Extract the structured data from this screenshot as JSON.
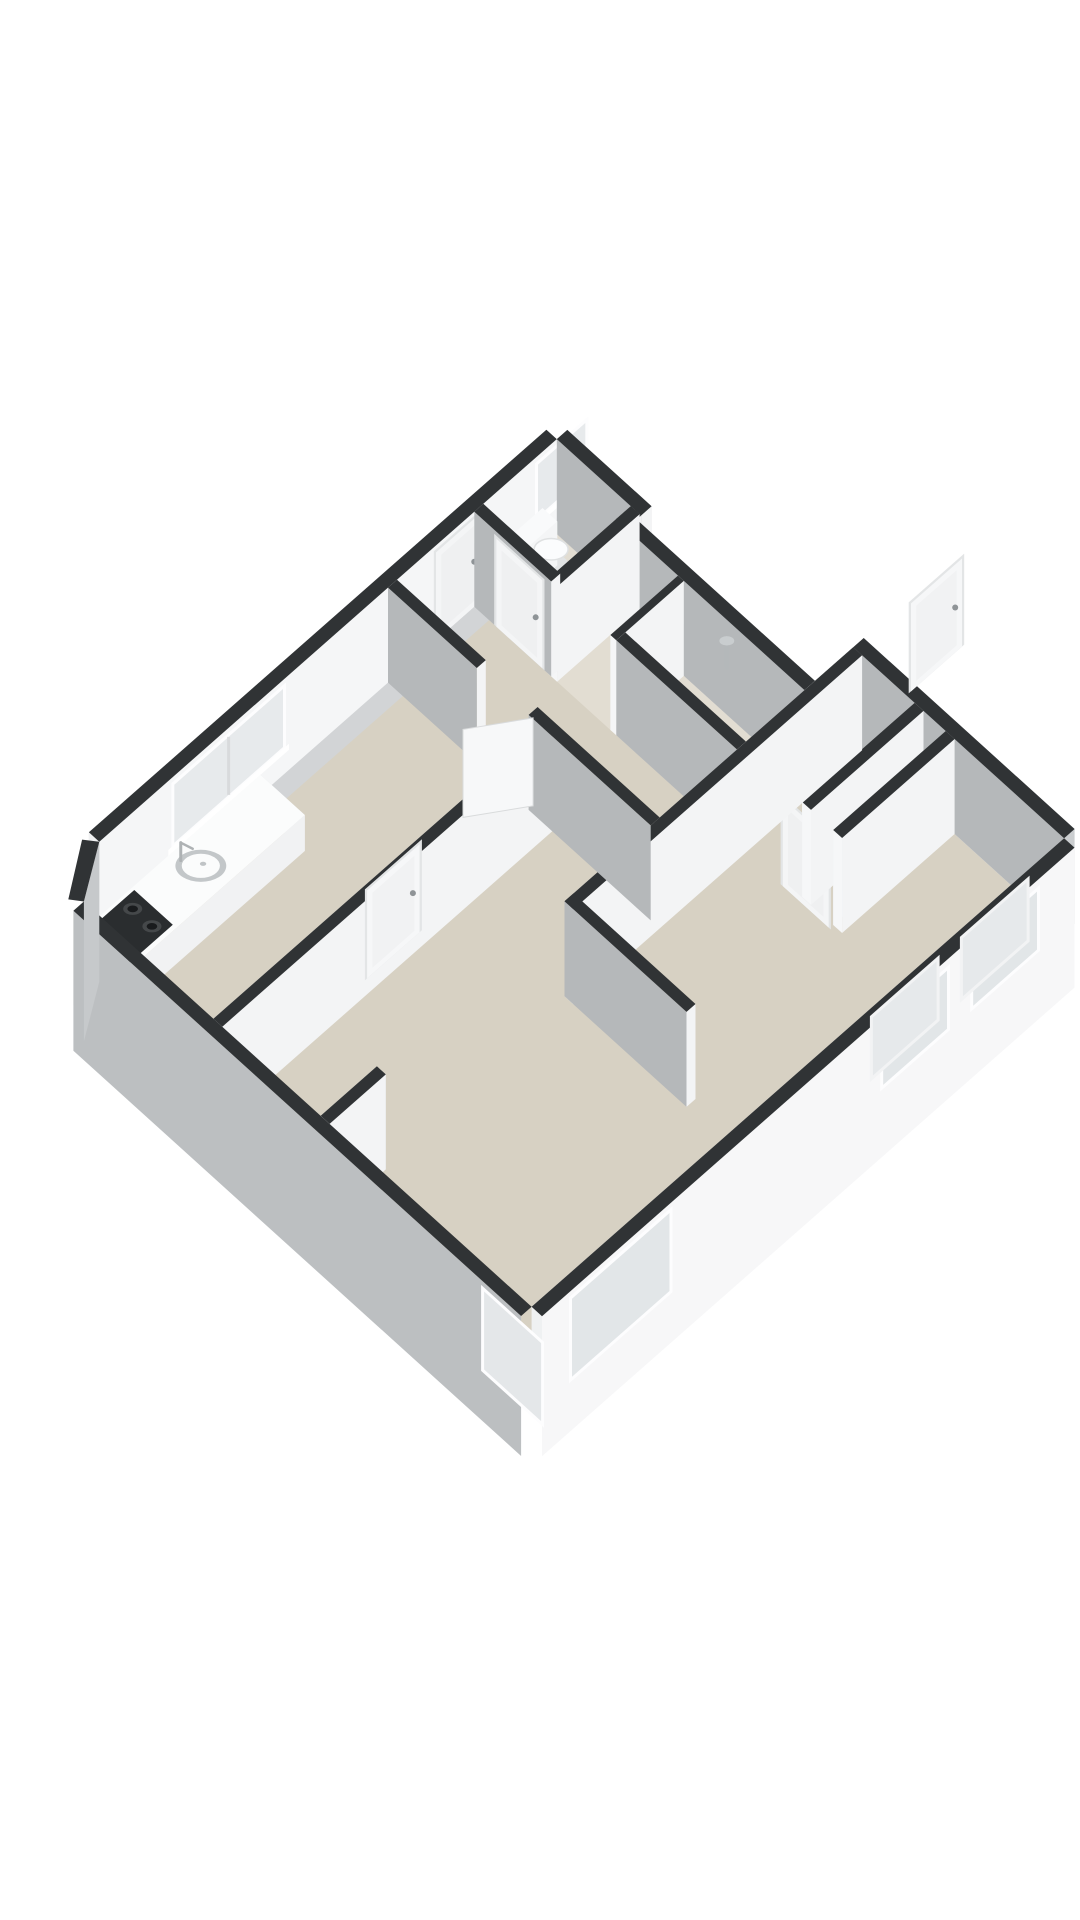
{
  "meta": {
    "label": "3D isometric floor plan of an apartment",
    "background": "#ffffff"
  },
  "palette": {
    "wall_top": "#303335",
    "wall_bright": "#f5f6f7",
    "wall_light": "#eef0f1",
    "wall_shadow": "#b5b8ba",
    "wall_outer_ne": "#cbced0",
    "wall_outer_nw": "#d2d4d6",
    "wall_outer_sw": "#bcbfc1",
    "wall_outer_se": "#f7f7f8",
    "floor_main": "#d7d1c3",
    "floor_wet": "#e2ddd2",
    "glass": "#e7eaec",
    "fixture_white": "#fbfcfd",
    "stove_black": "#2a2d2f",
    "chrome": "#aeb2b4"
  },
  "projection": {
    "origin": [
      58,
      973
    ],
    "au": [
      0.74,
      0.67
    ],
    "av": [
      0.75,
      -0.66
    ],
    "wall_height": 95,
    "skirt_depth": 45
  },
  "scene": [
    {
      "name": "floor-living-kitchen",
      "type": "floor",
      "z": 0,
      "color": "#d7d1c3",
      "points": [
        [
          35,
          0
        ],
        [
          640,
          0
        ],
        [
          640,
          710
        ],
        [
          355,
          710
        ],
        [
          355,
          645
        ],
        [
          114,
          645
        ],
        [
          114,
          665
        ],
        [
          0,
          665
        ],
        [
          0,
          55
        ]
      ]
    },
    {
      "name": "floor-wet-rooms",
      "type": "floor",
      "z": 0,
      "color": "#e2ddd2",
      "points": [
        [
          0,
          555
        ],
        [
          355,
          555
        ],
        [
          355,
          645
        ],
        [
          114,
          645
        ],
        [
          114,
          665
        ],
        [
          0,
          665
        ]
      ]
    },
    {
      "name": "wall-nw-facade",
      "type": "box",
      "x": [
        -14,
        0
      ],
      "y": [
        55,
        665
      ],
      "faces": {
        "top": "#303335",
        "E": "#f5f6f7",
        "W": "#d2d4d6",
        "S": "#f0f1f2"
      },
      "skirt": [
        "W"
      ],
      "decals": [
        {
          "kind": "window",
          "side": "E",
          "u": [
            100,
            245
          ],
          "z": [
            28,
            86
          ],
          "frame": "#fdfdfe",
          "glass": "#e7eaec",
          "mullion": true,
          "sill": true,
          "name": "kitchen-window"
        },
        {
          "kind": "window",
          "side": "E",
          "u": [
            585,
            648
          ],
          "z": [
            34,
            86
          ],
          "frame": "#fdfdfe",
          "glass": "#e7eaec",
          "sill": true,
          "name": "toilet-window"
        },
        {
          "kind": "door",
          "side": "E",
          "u": [
            449,
            509
          ],
          "z": [
            0,
            88
          ],
          "slab": "#f4f5f6",
          "handle": "end",
          "name": "entry-door"
        }
      ]
    },
    {
      "name": "wall-toilet-ne",
      "type": "box",
      "x": [
        0,
        114
      ],
      "y": [
        665,
        679
      ],
      "faces": {
        "top": "#303335",
        "S": "#b5b8ba",
        "N": "#cbced0",
        "E": "#f3f4f5"
      }
    },
    {
      "name": "wall-toilet-step",
      "type": "box",
      "x": [
        100,
        114
      ],
      "y": [
        645,
        665
      ],
      "faces": {
        "top": "#303335",
        "E": "#f3f4f5",
        "W": "#eef0f1"
      }
    },
    {
      "name": "wall-bath-ne",
      "type": "box",
      "x": [
        100,
        355
      ],
      "y": [
        645,
        659
      ],
      "faces": {
        "top": "#303335",
        "S": "#b5b8ba",
        "N": "#cbced0"
      }
    },
    {
      "name": "shower-pipe",
      "type": "rod",
      "from": [
        252,
        643,
        50
      ],
      "to": [
        252,
        643,
        74
      ],
      "w": 4,
      "color": "#b4b8ba"
    },
    {
      "name": "shower-arm",
      "type": "rod",
      "from": [
        252,
        643,
        74
      ],
      "to": [
        245,
        650,
        68
      ],
      "w": 3,
      "color": "#b4b8ba"
    },
    {
      "name": "shower-head",
      "type": "disc",
      "c": [
        244,
        651,
        66
      ],
      "r": 7,
      "color": "#c9cdcf"
    },
    {
      "name": "toilet-bowl-base",
      "type": "disc",
      "c": [
        40,
        620,
        26
      ],
      "r": 15,
      "color": "#e2e4e5"
    },
    {
      "name": "toilet-tank",
      "type": "box",
      "x": [
        4,
        24
      ],
      "y": [
        598,
        642
      ],
      "z": [
        0,
        44
      ],
      "faces": {
        "top": "#f9fafb",
        "S": "#ebedee",
        "E": "#f4f5f6"
      }
    },
    {
      "name": "toilet-bowl",
      "type": "disc",
      "c": [
        38,
        620,
        40
      ],
      "r": 16,
      "color": "#fbfcfd",
      "stroke": "#dfe1e2"
    },
    {
      "name": "wall-toilet-east",
      "type": "box",
      "x": [
        100,
        112
      ],
      "y": [
        555,
        665
      ],
      "faces": {
        "top": "#303335",
        "W": "#eef0f1",
        "E": "#f3f4f5",
        "S": "#f5f6f7"
      }
    },
    {
      "name": "wall-closet-east",
      "type": "box",
      "x": [
        184,
        192
      ],
      "y": [
        555,
        645
      ],
      "faces": {
        "top": "#303335",
        "W": "#eef0f1",
        "E": "#f3f4f5",
        "S": "#f5f6f7"
      }
    },
    {
      "name": "wall-ne-return",
      "type": "box",
      "x": [
        355,
        369
      ],
      "y": [
        645,
        710
      ],
      "faces": {
        "top": "#303335",
        "W": "#eef0f1",
        "S": "#f0f1f2"
      }
    },
    {
      "name": "wall-bedroom-ne",
      "type": "box",
      "x": [
        355,
        640
      ],
      "y": [
        710,
        724
      ],
      "faces": {
        "top": "#303335",
        "S": "#b5b8ba",
        "N": "#cbced0"
      },
      "decals": [
        {
          "kind": "slot",
          "side": "S",
          "u": [
            365,
            425
          ],
          "z": [
            55,
            83
          ],
          "frame": "#f4f5f6",
          "glass": "#3b3e40",
          "name": "bedroom-top-window"
        }
      ]
    },
    {
      "name": "wall-toilet-south",
      "type": "box",
      "x": [
        0,
        104
      ],
      "y": [
        555,
        567
      ],
      "faces": {
        "top": "#303335",
        "S": "#b5b8ba",
        "E": "#f3f4f5"
      },
      "decals": [
        {
          "kind": "door",
          "side": "S",
          "u": [
            30,
            92
          ],
          "z": [
            0,
            88
          ],
          "slab": "#f4f5f6",
          "handle": "end",
          "name": "toilet-door"
        }
      ]
    },
    {
      "name": "wall-bath-south",
      "type": "box",
      "x": [
        192,
        355
      ],
      "y": [
        555,
        567
      ],
      "faces": {
        "top": "#303335",
        "S": "#b5b8ba",
        "W": "#eef0f1",
        "E": "#f3f4f5"
      },
      "decals": [
        {
          "kind": "door",
          "side": "S",
          "u": [
            225,
            287
          ],
          "z": [
            0,
            88
          ],
          "slab": "#f4f5f6",
          "handle": "end",
          "name": "bathroom-door"
        }
      ]
    },
    {
      "name": "closet-partition-1",
      "type": "box",
      "x": [
        438,
        450
      ],
      "y": [
        560,
        710
      ],
      "faces": {
        "top": "#303335",
        "W": "#eef0f1",
        "E": "#f3f4f5",
        "S": "#f6f7f8"
      }
    },
    {
      "name": "closet-partition-2",
      "type": "box",
      "x": [
        480,
        492
      ],
      "y": [
        560,
        710
      ],
      "faces": {
        "top": "#303335",
        "W": "#eef0f1",
        "E": "#f3f4f5",
        "S": "#f6f7f8"
      }
    },
    {
      "name": "wall-bedroom-west",
      "type": "box",
      "x": [
        355,
        367
      ],
      "y": [
        325,
        710
      ],
      "faces": {
        "top": "#303335",
        "W": "#eef0f1",
        "E": "#f3f4f5",
        "S": "#f2f3f4"
      },
      "decals": [
        {
          "kind": "door",
          "side": "W",
          "u": [
            462,
            530
          ],
          "z": [
            0,
            88
          ],
          "slab": "#f6f7f8",
          "handle": "end",
          "name": "bedroom-door"
        }
      ]
    },
    {
      "name": "wall-bedroom-south",
      "type": "box",
      "x": [
        355,
        520
      ],
      "y": [
        325,
        337
      ],
      "faces": {
        "top": "#303335",
        "S": "#b5b8ba",
        "E": "#f3f4f5"
      }
    },
    {
      "name": "kitchen-counter",
      "type": "box",
      "x": [
        12,
        72
      ],
      "y": [
        12,
        258
      ],
      "z": [
        0,
        36
      ],
      "faces": {
        "top": "#fbfcfc",
        "S": "#e8eaeb",
        "E": "#f1f2f3",
        "N": "#e2e4e5"
      }
    },
    {
      "name": "stove-plate",
      "type": "plate",
      "z": 37,
      "color": "#2a2d2f",
      "points": [
        [
          16,
          18
        ],
        [
          68,
          18
        ],
        [
          68,
          86
        ],
        [
          16,
          86
        ]
      ]
    },
    {
      "name": "burner-ring-1",
      "type": "disc",
      "c": [
        30,
        33,
        38
      ],
      "r": 9,
      "color": "#45484a"
    },
    {
      "name": "burner-1",
      "type": "disc",
      "c": [
        30,
        33,
        38
      ],
      "r": 5,
      "color": "#191b1d"
    },
    {
      "name": "burner-ring-2",
      "type": "disc",
      "c": [
        56,
        33,
        38
      ],
      "r": 9,
      "color": "#45484a"
    },
    {
      "name": "burner-2",
      "type": "disc",
      "c": [
        56,
        33,
        38
      ],
      "r": 5,
      "color": "#191b1d"
    },
    {
      "name": "burner-ring-3",
      "type": "disc",
      "c": [
        30,
        70,
        38
      ],
      "r": 9,
      "color": "#45484a"
    },
    {
      "name": "burner-3",
      "type": "disc",
      "c": [
        30,
        70,
        38
      ],
      "r": 5,
      "color": "#191b1d"
    },
    {
      "name": "burner-ring-4",
      "type": "disc",
      "c": [
        56,
        70,
        38
      ],
      "r": 9,
      "color": "#45484a"
    },
    {
      "name": "burner-4",
      "type": "disc",
      "c": [
        56,
        70,
        38
      ],
      "r": 5,
      "color": "#191b1d"
    },
    {
      "name": "sink-rim",
      "type": "disc",
      "c": [
        42,
        149,
        37
      ],
      "r": 24,
      "color": "#c3c7c9"
    },
    {
      "name": "sink-basin",
      "type": "disc",
      "c": [
        42,
        149,
        37
      ],
      "r": 18,
      "color": "#fbfcfc"
    },
    {
      "name": "sink-drain",
      "type": "disc",
      "c": [
        42,
        152,
        37
      ],
      "r": 3,
      "color": "#c0c4c6"
    },
    {
      "name": "kitchen-faucet-pipe",
      "type": "rod",
      "from": [
        24,
        140,
        36
      ],
      "to": [
        24,
        140,
        54
      ],
      "w": 3,
      "color": "#aeb2b4"
    },
    {
      "name": "kitchen-faucet-spout",
      "type": "rod",
      "from": [
        24,
        140,
        54
      ],
      "to": [
        32,
        148,
        48
      ],
      "w": 2.5,
      "color": "#aeb2b4"
    },
    {
      "name": "wall-kitchen-east",
      "type": "box",
      "x": [
        210,
        222
      ],
      "y": [
        0,
        440
      ],
      "faces": {
        "top": "#303335",
        "W": "#eef0f1",
        "E": "#f3f4f5"
      },
      "decals": [
        {
          "kind": "door",
          "side": "W",
          "u": [
            205,
            275
          ],
          "z": [
            0,
            88
          ],
          "slab": "#f6f7f8",
          "handle": "end",
          "name": "kitchen-door"
        }
      ]
    },
    {
      "name": "wall-hall-south-west",
      "type": "box",
      "x": [
        0,
        120
      ],
      "y": [
        440,
        452
      ],
      "faces": {
        "top": "#303335",
        "S": "#b5b8ba",
        "E": "#f3f4f5"
      }
    },
    {
      "name": "wall-hall-south-east",
      "type": "box",
      "x": [
        190,
        355
      ],
      "y": [
        440,
        452
      ],
      "faces": {
        "top": "#303335",
        "S": "#b5b8ba",
        "W": "#eef0f1"
      }
    },
    {
      "name": "open-door-leaf",
      "type": "panel",
      "from": [
        190,
        446
      ],
      "to": [
        152,
        390
      ],
      "z": [
        0,
        88
      ],
      "color": "#f7f8f9",
      "stroke": "#d9dbdc"
    },
    {
      "name": "wall-living-stub",
      "type": "box",
      "x": [
        355,
        367
      ],
      "y": [
        0,
        75
      ],
      "faces": {
        "top": "#303335",
        "W": "#eef0f1",
        "E": "#f3f4f5",
        "N": "#d0d3d5"
      }
    },
    {
      "name": "wall-se-facade",
      "type": "box",
      "x": [
        640,
        654
      ],
      "y": [
        0,
        710
      ],
      "faces": {
        "top": "#303335",
        "E": "#f7f7f8",
        "W": "#eff1f2"
      },
      "skirt": [
        "E"
      ],
      "decals": [
        {
          "kind": "window",
          "side": "E",
          "u": [
            40,
            170
          ],
          "z": [
            8,
            86
          ],
          "frame": "#fdfdfe",
          "glass": "#e2e6e8",
          "name": "living-window-se"
        },
        {
          "kind": "window",
          "side": "E",
          "u": [
            455,
            540
          ],
          "z": [
            26,
            84
          ],
          "frame": "#fdfdfe",
          "glass": "#e2e6e8",
          "name": "bedroom-window-1"
        },
        {
          "kind": "window",
          "side": "E",
          "u": [
            575,
            660
          ],
          "z": [
            26,
            84
          ],
          "frame": "#fdfdfe",
          "glass": "#e2e6e8",
          "name": "bedroom-window-2"
        },
        {
          "kind": "window",
          "side": "W",
          "u": [
            455,
            540
          ],
          "z": [
            26,
            84
          ],
          "frame": "#f2f3f4",
          "glass": "#e6e9eb",
          "name": "bedroom-window-1-inner"
        },
        {
          "kind": "window",
          "side": "W",
          "u": [
            575,
            660
          ],
          "z": [
            26,
            84
          ],
          "frame": "#f2f3f4",
          "glass": "#e6e9eb",
          "name": "bedroom-window-2-inner"
        }
      ]
    },
    {
      "name": "wall-sw-facade",
      "type": "box",
      "x": [
        35,
        640
      ],
      "y": [
        -14,
        0
      ],
      "faces": {
        "top": "#303335",
        "S": "#bcbfc1",
        "W": "#eef0f1"
      },
      "skirt": [
        "S"
      ],
      "decals": [
        {
          "kind": "window",
          "side": "S",
          "u": [
            555,
            632
          ],
          "z": [
            8,
            86
          ],
          "frame": "#fdfdfe",
          "glass": "#e4e7e9",
          "name": "living-window-sw"
        }
      ]
    },
    {
      "name": "chamfer-wall-face",
      "type": "panel",
      "from": [
        0,
        55
      ],
      "to": [
        35,
        0
      ],
      "z": [
        -45,
        95
      ],
      "color": "#c6c9cb",
      "stroke": "none"
    },
    {
      "name": "chamfer-wall-top",
      "type": "plate",
      "z": 95,
      "color": "#303335",
      "points": [
        [
          0,
          55
        ],
        [
          35,
          0
        ],
        [
          23,
          -9
        ],
        [
          -13,
          45
        ]
      ]
    }
  ]
}
